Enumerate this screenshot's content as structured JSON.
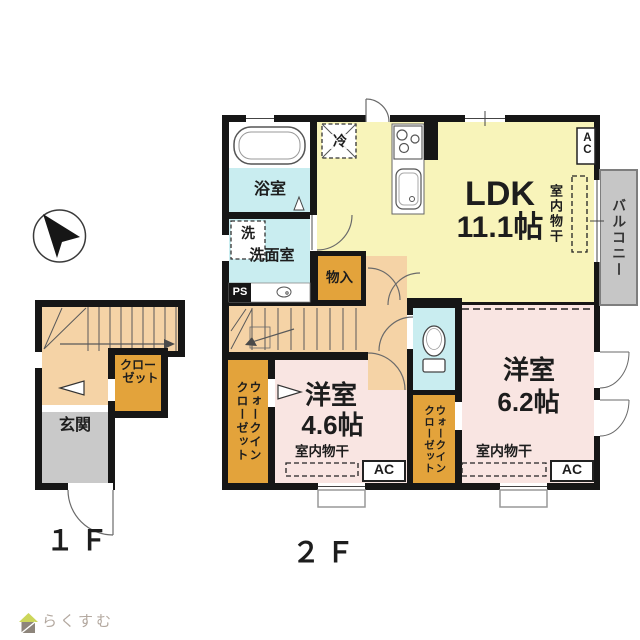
{
  "compass": {
    "name": "north-arrow"
  },
  "floor1": {
    "label": "１Ｆ",
    "entrance": "玄関",
    "closet_line1": "クロー",
    "closet_line2": "ゼット"
  },
  "floor2": {
    "label": "２Ｆ",
    "ldk_name": "LDK",
    "ldk_size": "11.1帖",
    "bathroom": "浴室",
    "washer": "洗",
    "washroom": "洗面室",
    "pipe_space": "PS",
    "storage": "物入",
    "fridge": "冷",
    "indoor_drying": "室内物干",
    "balcony": "バルコニー",
    "ac_label": "AC",
    "wic_line1": "ウォークイン",
    "wic_line2": "クローゼット",
    "bedroom1_name": "洋室",
    "bedroom1_size": "4.6帖",
    "bedroom2_name": "洋室",
    "bedroom2_size": "6.2帖"
  },
  "watermark": {
    "text": "らくすむ"
  },
  "colors": {
    "wall": "#161616",
    "ldk_yellow": "#f8f4ba",
    "wet_cyan": "#c9edf0",
    "bedroom_pink": "#f9e5e2",
    "hall_peach": "#f5d3a6",
    "closet_orange": "#e3a33b",
    "entrance_gray": "#c9c9c9",
    "balcony_gray": "#c6c6c6"
  }
}
